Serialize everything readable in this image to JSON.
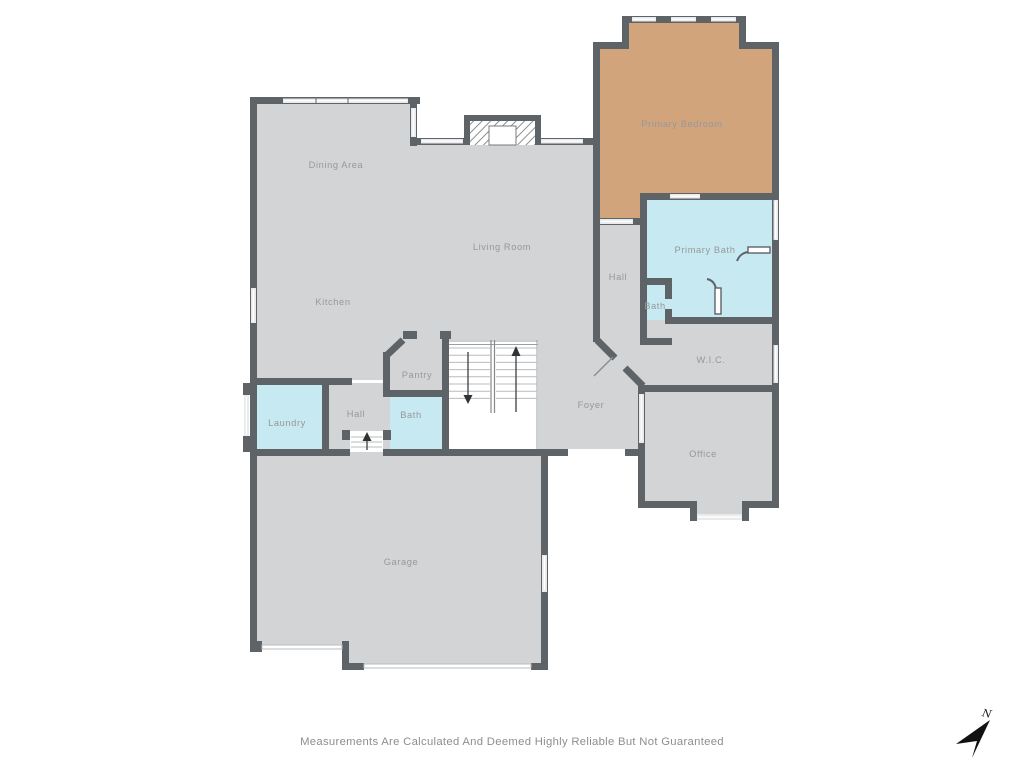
{
  "plan": {
    "rooms": [
      {
        "id": "dining-area",
        "label": "Dining Area"
      },
      {
        "id": "kitchen",
        "label": "Kitchen"
      },
      {
        "id": "living-room",
        "label": "Living Room"
      },
      {
        "id": "primary-bedroom",
        "label": "Primary Bedroom"
      },
      {
        "id": "primary-bath",
        "label": "Primary Bath"
      },
      {
        "id": "hall-upper",
        "label": "Hall"
      },
      {
        "id": "bath-upper",
        "label": "Bath"
      },
      {
        "id": "wic",
        "label": "W.I.C."
      },
      {
        "id": "foyer",
        "label": "Foyer"
      },
      {
        "id": "office",
        "label": "Office"
      },
      {
        "id": "pantry",
        "label": "Pantry"
      },
      {
        "id": "bath-lower",
        "label": "Bath"
      },
      {
        "id": "hall-lower",
        "label": "Hall"
      },
      {
        "id": "laundry",
        "label": "Laundry"
      },
      {
        "id": "garage",
        "label": "Garage"
      }
    ],
    "colors": {
      "wall": "#5e6367",
      "floor": "#d3d4d6",
      "bedroom": "#d2a47c",
      "wet_rooms": "#c7e9f1",
      "window": "#e9eaeb",
      "background": "#ffffff"
    },
    "compass": {
      "label": "N"
    },
    "disclaimer": "Measurements Are Calculated And Deemed Highly Reliable But Not Guaranteed"
  }
}
